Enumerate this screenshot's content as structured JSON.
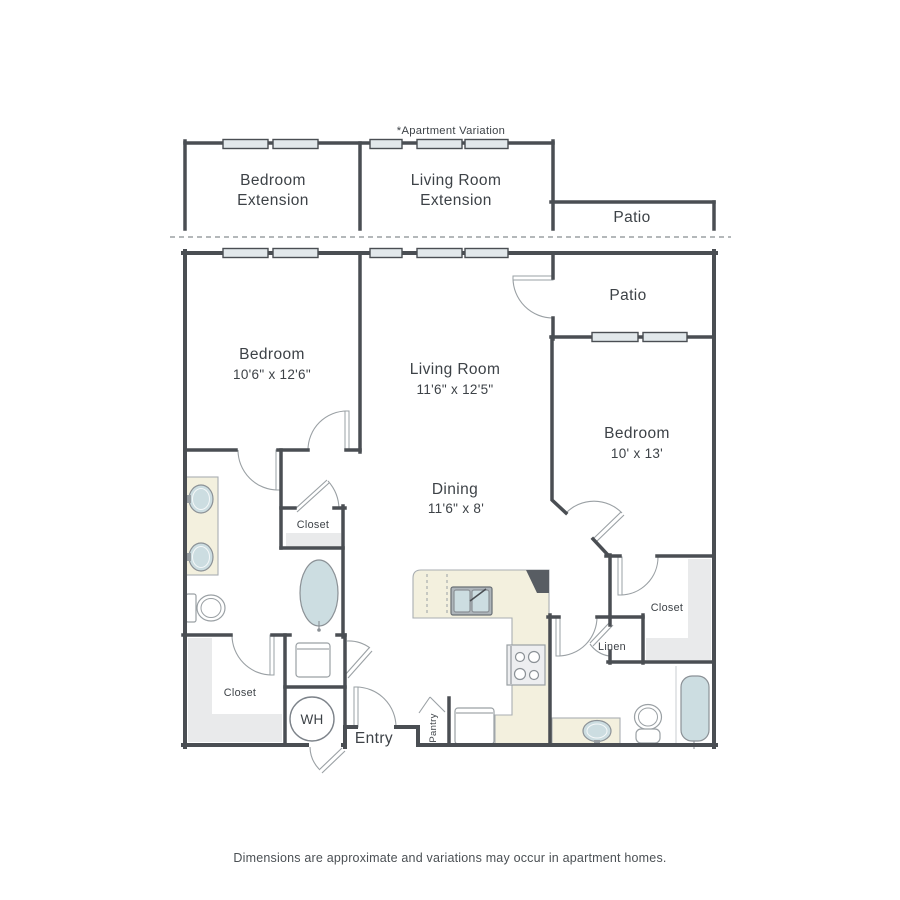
{
  "annotation": "*Apartment Variation",
  "footer": "Dimensions are approximate and variations may occur in apartment homes.",
  "variation": {
    "bedroom_extension": {
      "line1": "Bedroom",
      "line2": "Extension"
    },
    "living_extension": {
      "line1": "Living Room",
      "line2": "Extension"
    },
    "patio": "Patio"
  },
  "rooms": {
    "bedroom1": {
      "name": "Bedroom",
      "dims": "10'6\" x 12'6\""
    },
    "living_room": {
      "name": "Living Room",
      "dims": "11'6\" x 12'5\""
    },
    "patio": "Patio",
    "bedroom2": {
      "name": "Bedroom",
      "dims": "10' x 13'"
    },
    "dining": {
      "name": "Dining",
      "dims": "11'6\" x 8'"
    }
  },
  "labels": {
    "hall_closet": "Closet",
    "entry_closet": "Closet",
    "bedroom2_closet": "Closet",
    "linen": "Linen",
    "entry": "Entry",
    "pantry": "Pantry",
    "water_heater": "WH"
  },
  "colors": {
    "wall": "#4a4e53",
    "window_fill": "#e2e8eb",
    "counter": "#f3f0de",
    "fixture_blue": "#ccdde1",
    "shelf_gray": "#e9eaeb",
    "door_line": "#9aa0a4",
    "text": "#3d4247"
  }
}
